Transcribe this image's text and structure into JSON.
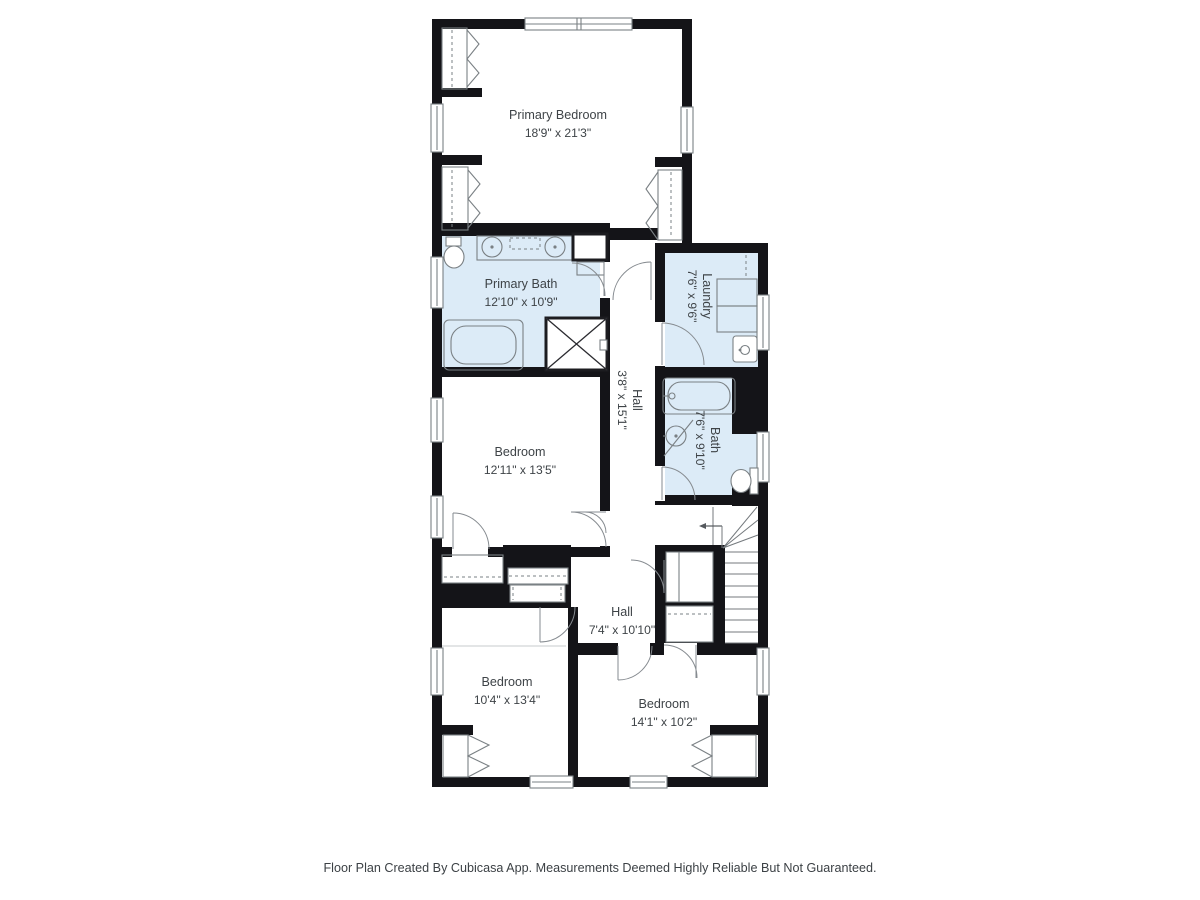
{
  "colors": {
    "wall": "#141418",
    "room-blue": "#dcebf7",
    "line": "#7a8084",
    "text": "#3e4347",
    "bg": "#ffffff"
  },
  "rooms": {
    "primary_bedroom": {
      "name": "Primary Bedroom",
      "dims": "18'9\" x 21'3\""
    },
    "primary_bath": {
      "name": "Primary Bath",
      "dims": "12'10\" x 10'9\""
    },
    "laundry": {
      "name": "Laundry",
      "dims": "7'6\" x 9'6\""
    },
    "hall_upper": {
      "name": "Hall",
      "dims": "3'8\" x 15'1\""
    },
    "bath": {
      "name": "Bath",
      "dims": "7'6\" x 9'10\""
    },
    "bedroom_middle": {
      "name": "Bedroom",
      "dims": "12'11\" x 13'5\""
    },
    "hall_lower": {
      "name": "Hall",
      "dims": "7'4\" x 10'10\""
    },
    "bedroom_bottom_left": {
      "name": "Bedroom",
      "dims": "10'4\" x 13'4\""
    },
    "bedroom_bottom_right": {
      "name": "Bedroom",
      "dims": "14'1\" x 10'2\""
    }
  },
  "footer": {
    "disclaimer": "Floor Plan Created By Cubicasa App. Measurements Deemed Highly Reliable But Not Guaranteed."
  }
}
